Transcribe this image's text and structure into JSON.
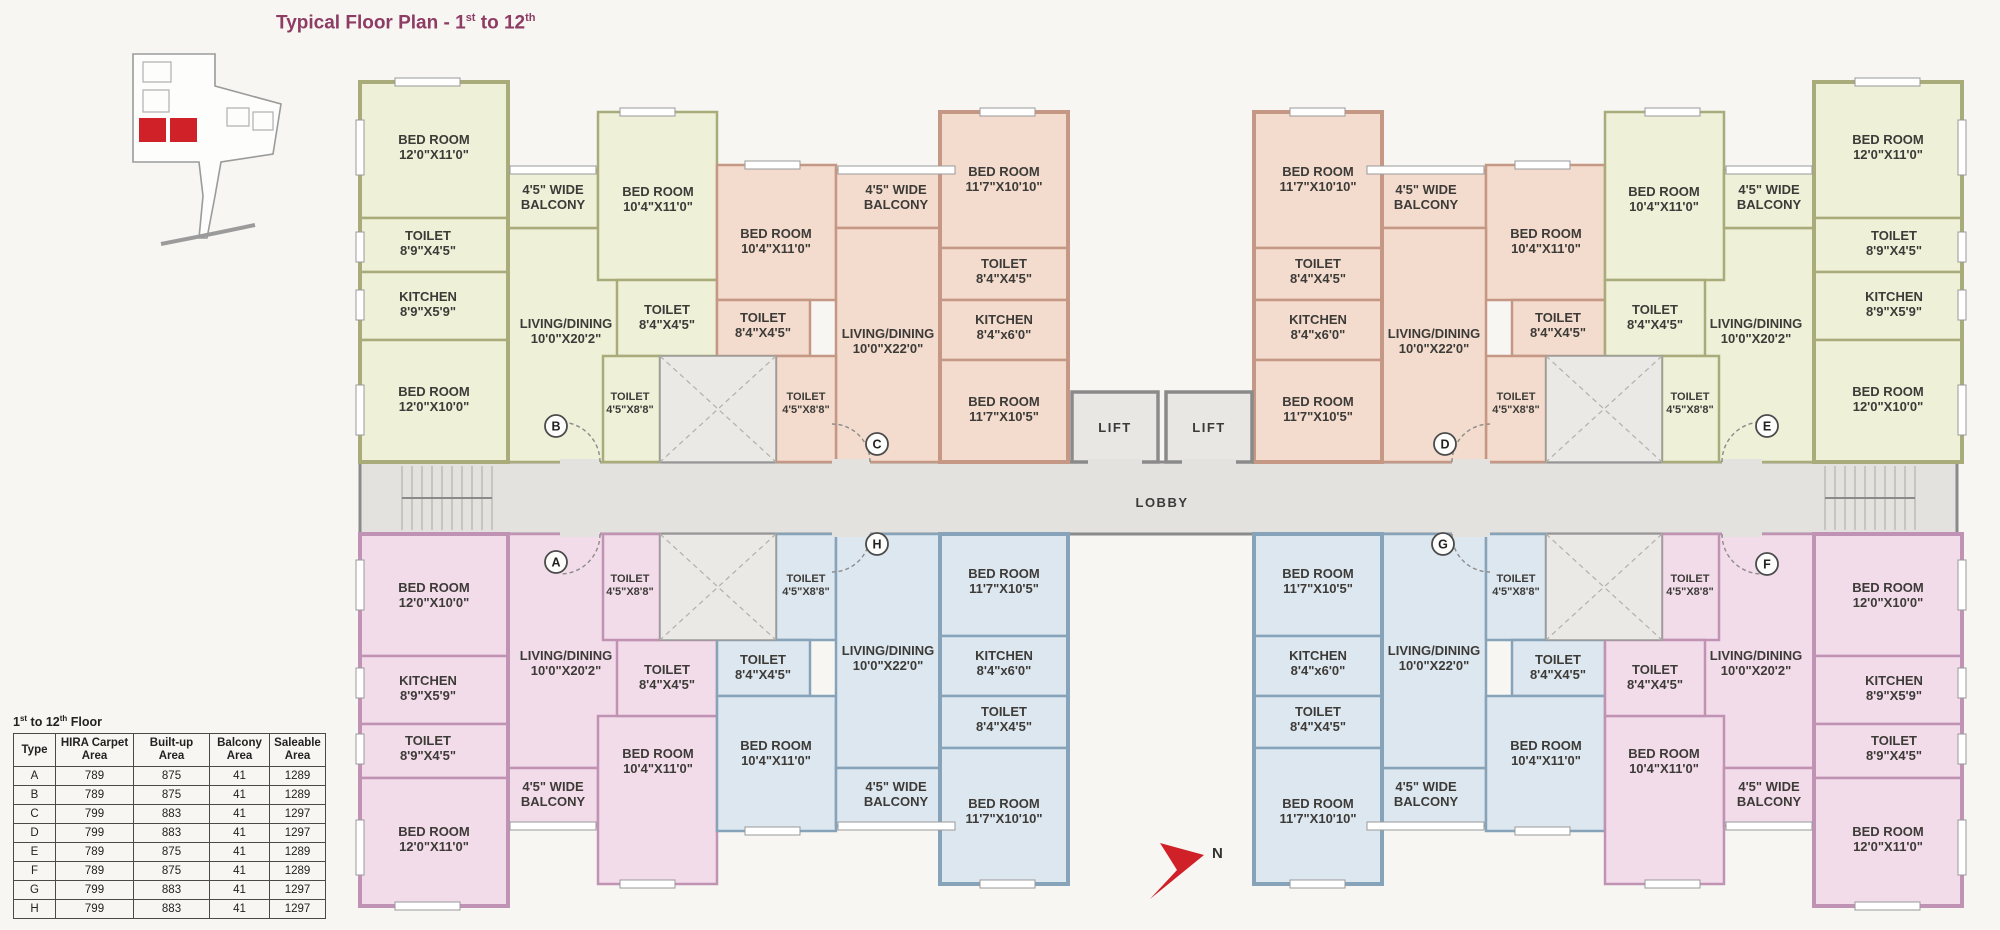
{
  "title": {
    "full": "Typical Floor Plan - 1st to 12th",
    "prefix": "Typical Floor Plan - 1",
    "sup1": "st",
    "mid": " to 12",
    "sup2": "th"
  },
  "compass": {
    "label": "N"
  },
  "lobby": {
    "label": "LOBBY"
  },
  "lifts": {
    "lift1": "LIFT",
    "lift2": "LIFT"
  },
  "colors": {
    "accent_title": "#8e3c64",
    "key_highlight": "#d02028",
    "compass_red": "#d02028",
    "unit_green_fill": "#eef0d8",
    "unit_green_wall": "#a9ab7b",
    "unit_peach_fill": "#f3dccd",
    "unit_peach_wall": "#c59885",
    "unit_pink_fill": "#f3dce9",
    "unit_pink_wall": "#c093b4",
    "unit_blue_fill": "#dde7ef",
    "unit_blue_wall": "#87a3ba",
    "core_gray": "#e4e2de"
  },
  "units": {
    "A": {
      "circle": "A",
      "rooms": [
        {
          "l1": "BED ROOM",
          "l2": "12'0\"X10'0\""
        },
        {
          "l1": "KITCHEN",
          "l2": "8'9\"X5'9\""
        },
        {
          "l1": "TOILET",
          "l2": "8'9\"X4'5\""
        },
        {
          "l1": "BED ROOM",
          "l2": "12'0\"X11'0\""
        },
        {
          "l1": "LIVING/DINING",
          "l2": "10'0\"X20'2\""
        },
        {
          "l1": "4'5\" WIDE",
          "l2": "BALCONY"
        },
        {
          "l1": "BED ROOM",
          "l2": "10'4\"X11'0\""
        },
        {
          "l1": "TOILET",
          "l2": "8'4\"X4'5\""
        },
        {
          "l1": "TOILET",
          "l2": "4'5\"X8'8\""
        }
      ]
    },
    "B": {
      "circle": "B",
      "rooms": [
        {
          "l1": "BED ROOM",
          "l2": "12'0\"X11'0\""
        },
        {
          "l1": "TOILET",
          "l2": "8'9\"X4'5\""
        },
        {
          "l1": "KITCHEN",
          "l2": "8'9\"X5'9\""
        },
        {
          "l1": "BED ROOM",
          "l2": "12'0\"X10'0\""
        },
        {
          "l1": "LIVING/DINING",
          "l2": "10'0\"X20'2\""
        },
        {
          "l1": "4'5\" WIDE",
          "l2": "BALCONY"
        },
        {
          "l1": "BED ROOM",
          "l2": "10'4\"X11'0\""
        },
        {
          "l1": "TOILET",
          "l2": "8'4\"X4'5\""
        },
        {
          "l1": "TOILET",
          "l2": "4'5\"X8'8\""
        }
      ]
    },
    "C": {
      "circle": "C",
      "rooms": [
        {
          "l1": "BED ROOM",
          "l2": "10'4\"X11'0\""
        },
        {
          "l1": "TOILET",
          "l2": "8'4\"X4'5\""
        },
        {
          "l1": "4'5\" WIDE",
          "l2": "BALCONY"
        },
        {
          "l1": "BED ROOM",
          "l2": "11'7\"X10'10\""
        },
        {
          "l1": "TOILET",
          "l2": "8'4\"X4'5\""
        },
        {
          "l1": "KITCHEN",
          "l2": "8'4\"x6'0\""
        },
        {
          "l1": "LIVING/DINING",
          "l2": "10'0\"X22'0\""
        },
        {
          "l1": "BED ROOM",
          "l2": "11'7\"X10'5\""
        },
        {
          "l1": "TOILET",
          "l2": "4'5\"X8'8\""
        }
      ]
    },
    "D": {
      "circle": "D",
      "rooms": [
        {
          "l1": "BED ROOM",
          "l2": "11'7\"X10'10\""
        },
        {
          "l1": "TOILET",
          "l2": "8'4\"X4'5\""
        },
        {
          "l1": "KITCHEN",
          "l2": "8'4\"x6'0\""
        },
        {
          "l1": "BED ROOM",
          "l2": "11'7\"X10'5\""
        },
        {
          "l1": "4'5\" WIDE",
          "l2": "BALCONY"
        },
        {
          "l1": "BED ROOM",
          "l2": "10'4\"X11'0\""
        },
        {
          "l1": "TOILET",
          "l2": "8'4\"X4'5\""
        },
        {
          "l1": "TOILET",
          "l2": "4'5\"X8'8\""
        },
        {
          "l1": "LIVING/DINING",
          "l2": "10'0\"X22'0\""
        }
      ]
    },
    "E": {
      "circle": "E",
      "rooms": [
        {
          "l1": "BED ROOM",
          "l2": "10'4\"X11'0\""
        },
        {
          "l1": "TOILET",
          "l2": "8'4\"X4'5\""
        },
        {
          "l1": "TOILET",
          "l2": "4'5\"X8'8\""
        },
        {
          "l1": "4'5\" WIDE",
          "l2": "BALCONY"
        },
        {
          "l1": "LIVING/DINING",
          "l2": "10'0\"X20'2\""
        },
        {
          "l1": "BED ROOM",
          "l2": "12'0\"X11'0\""
        },
        {
          "l1": "TOILET",
          "l2": "8'9\"X4'5\""
        },
        {
          "l1": "KITCHEN",
          "l2": "8'9\"X5'9\""
        },
        {
          "l1": "BED ROOM",
          "l2": "12'0\"X10'0\""
        }
      ]
    },
    "F": {
      "circle": "F",
      "rooms": [
        {
          "l1": "TOILET",
          "l2": "4'5\"X8'8\""
        },
        {
          "l1": "LIVING/DINING",
          "l2": "10'0\"X20'2\""
        },
        {
          "l1": "BED ROOM",
          "l2": "10'4\"X11'0\""
        },
        {
          "l1": "TOILET",
          "l2": "8'4\"X4'5\""
        },
        {
          "l1": "4'5\" WIDE",
          "l2": "BALCONY"
        },
        {
          "l1": "BED ROOM",
          "l2": "12'0\"X10'0\""
        },
        {
          "l1": "KITCHEN",
          "l2": "8'9\"X5'9\""
        },
        {
          "l1": "TOILET",
          "l2": "8'9\"X4'5\""
        },
        {
          "l1": "BED ROOM",
          "l2": "12'0\"X11'0\""
        }
      ]
    },
    "G": {
      "circle": "G",
      "rooms": [
        {
          "l1": "BED ROOM",
          "l2": "11'7\"X10'5\""
        },
        {
          "l1": "KITCHEN",
          "l2": "8'4\"x6'0\""
        },
        {
          "l1": "TOILET",
          "l2": "8'4\"X4'5\""
        },
        {
          "l1": "BED ROOM",
          "l2": "11'7\"X10'10\""
        },
        {
          "l1": "LIVING/DINING",
          "l2": "10'0\"X22'0\""
        },
        {
          "l1": "TOILET",
          "l2": "4'5\"X8'8\""
        },
        {
          "l1": "TOILET",
          "l2": "8'4\"X4'5\""
        },
        {
          "l1": "BED ROOM",
          "l2": "10'4\"X11'0\""
        },
        {
          "l1": "4'5\" WIDE",
          "l2": "BALCONY"
        }
      ]
    },
    "H": {
      "circle": "H",
      "rooms": [
        {
          "l1": "TOILET",
          "l2": "4'5\"X8'8\""
        },
        {
          "l1": "TOILET",
          "l2": "8'4\"X4'5\""
        },
        {
          "l1": "BED ROOM",
          "l2": "10'4\"X11'0\""
        },
        {
          "l1": "LIVING/DINING",
          "l2": "10'0\"X22'0\""
        },
        {
          "l1": "4'5\" WIDE",
          "l2": "BALCONY"
        },
        {
          "l1": "BED ROOM",
          "l2": "11'7\"X10'5\""
        },
        {
          "l1": "KITCHEN",
          "l2": "8'4\"x6'0\""
        },
        {
          "l1": "TOILET",
          "l2": "8'4\"X4'5\""
        },
        {
          "l1": "BED ROOM",
          "l2": "11'7\"X10'10\""
        }
      ]
    }
  },
  "area_table": {
    "title": {
      "p1": "1",
      "sup1": "st",
      "p2": " to 12",
      "sup2": "th",
      "p3": " Floor"
    },
    "headers": [
      "Type",
      "HIRA Carpet Area",
      "Built-up Area",
      "Balcony Area",
      "Saleable Area"
    ],
    "rows": [
      {
        "type": "A",
        "carpet": "789",
        "builtup": "875",
        "balcony": "41",
        "saleable": "1289"
      },
      {
        "type": "B",
        "carpet": "789",
        "builtup": "875",
        "balcony": "41",
        "saleable": "1289"
      },
      {
        "type": "C",
        "carpet": "799",
        "builtup": "883",
        "balcony": "41",
        "saleable": "1297"
      },
      {
        "type": "D",
        "carpet": "799",
        "builtup": "883",
        "balcony": "41",
        "saleable": "1297"
      },
      {
        "type": "E",
        "carpet": "789",
        "builtup": "875",
        "balcony": "41",
        "saleable": "1289"
      },
      {
        "type": "F",
        "carpet": "789",
        "builtup": "875",
        "balcony": "41",
        "saleable": "1289"
      },
      {
        "type": "G",
        "carpet": "799",
        "builtup": "883",
        "balcony": "41",
        "saleable": "1297"
      },
      {
        "type": "H",
        "carpet": "799",
        "builtup": "883",
        "balcony": "41",
        "saleable": "1297"
      }
    ]
  }
}
